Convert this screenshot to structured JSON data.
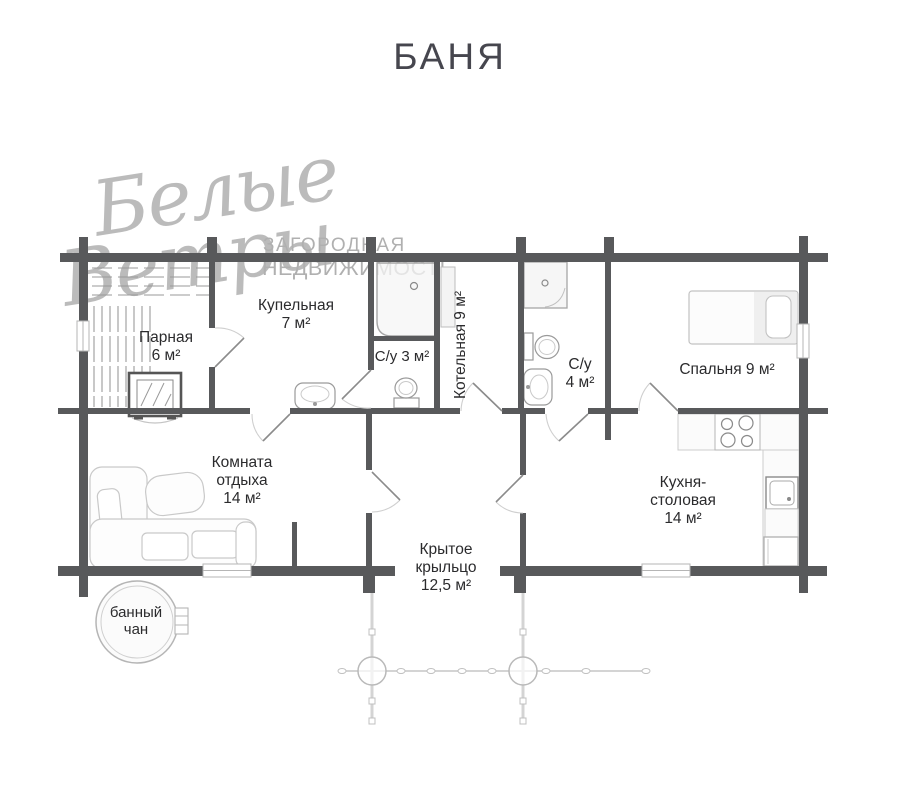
{
  "header": {
    "title": "БАНЯ"
  },
  "watermark": {
    "script1": "Белые",
    "script2": "Ветры",
    "caption1": "ЗАГОРОДНАЯ",
    "caption2": "НЕДВИЖИМОСТЬ"
  },
  "rooms": {
    "parnaya": {
      "line1": "Парная",
      "line2": "6 м²"
    },
    "kupelnaya": {
      "line1": "Купельная",
      "line2": "7 м²"
    },
    "su3": {
      "line1": "С/у 3 м²"
    },
    "kotelnaya": {
      "line1": "Котельная 9 м²"
    },
    "su4": {
      "line1": "С/у",
      "line2": "4 м²"
    },
    "spalnya": {
      "line1": "Спальня 9 м²"
    },
    "komnata_otdykha": {
      "line1": "Комната",
      "line2": "отдыха",
      "line3": "14 м²"
    },
    "kukhnya": {
      "line1": "Кухня-",
      "line2": "столовая",
      "line3": "14 м²"
    },
    "kryltso": {
      "line1": "Крытое",
      "line2": "крыльцо",
      "line3": "12,5 м²"
    },
    "bannyy_chan": {
      "line1": "банный",
      "line2": "чан"
    }
  },
  "colors": {
    "wall": "#58595b",
    "text": "#2b2b2d",
    "watermark": "#b0b0b0",
    "furniture_outline": "#c9c9c9"
  }
}
